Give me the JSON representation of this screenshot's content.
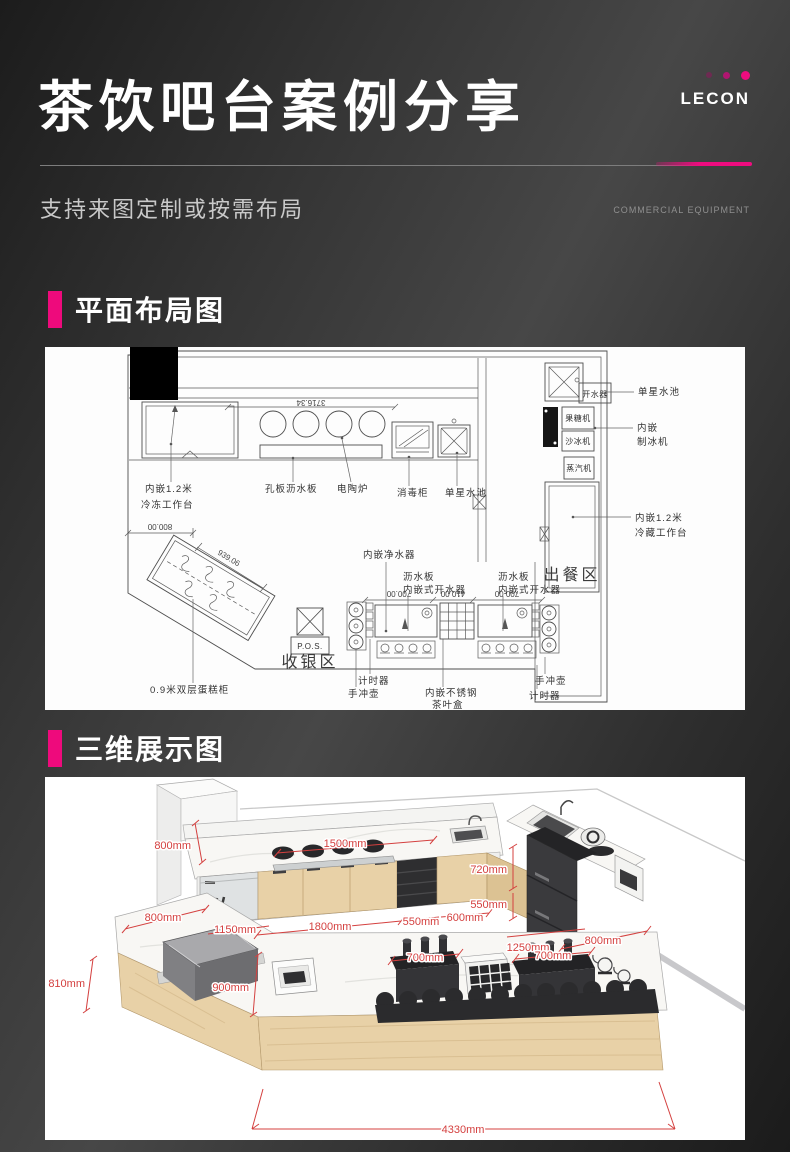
{
  "header": {
    "title": "茶饮吧台案例分享",
    "subtitle": "支持来图定制或按需布局",
    "brand": "LECON",
    "brand_tagline": "COMMERCIAL EQUIPMENT",
    "accent_color": "#ee0c7f"
  },
  "sections": {
    "plan_title": "平面布局图",
    "viz_title": "三维展示图"
  },
  "floor_plan": {
    "dim_top": "3716.34",
    "dim_left": "800.00",
    "dim_diag": "939.06",
    "dim_c1": "700.00",
    "dim_c2": "410.00",
    "dim_c3": "700.00",
    "freezer1": "内嵌1.2米",
    "freezer2": "冷冻工作台",
    "drainboard": "孔板沥水板",
    "stove": "电陶炉",
    "disinfect": "消毒柜",
    "sink_mid": "单星水池",
    "boiler_box": "开水器",
    "sink_right": "单星水池",
    "fructose": "果糖机",
    "slush": "沙冰机",
    "ice1": "内嵌",
    "ice2": "制冰机",
    "steam": "蒸汽机",
    "fridge1": "内嵌1.2米",
    "fridge2": "冷藏工作台",
    "serving": "出餐区",
    "cashier": "收银区",
    "pos": "P.O.S.",
    "cake": "0.9米双层蛋糕柜",
    "purifier": "内嵌净水器",
    "drain_l": "沥水板",
    "boiler_l": "内嵌式开水器",
    "drain_r": "沥水板",
    "boiler_r": "内嵌式开水器",
    "timer_l": "计时器",
    "kettle_l": "手冲壶",
    "teabox1": "内嵌不锈钢",
    "teabox2": "茶叶盒",
    "kettle_r": "手冲壶",
    "timer_r": "计时器"
  },
  "render3d": {
    "dim_color": "#d4403f",
    "d_back_h": "800mm",
    "d_1500": "1500mm",
    "d_left800": "800mm",
    "d_1150": "1150mm",
    "d_1800": "1800mm",
    "d_550a": "550mm",
    "d_600": "600mm",
    "d_720": "720mm",
    "d_550b": "550mm",
    "d_1250": "1250mm",
    "d_800r": "800mm",
    "d_700a": "700mm",
    "d_700b": "700mm",
    "d_900": "900mm",
    "d_810": "810mm",
    "d_4330": "4330mm"
  }
}
